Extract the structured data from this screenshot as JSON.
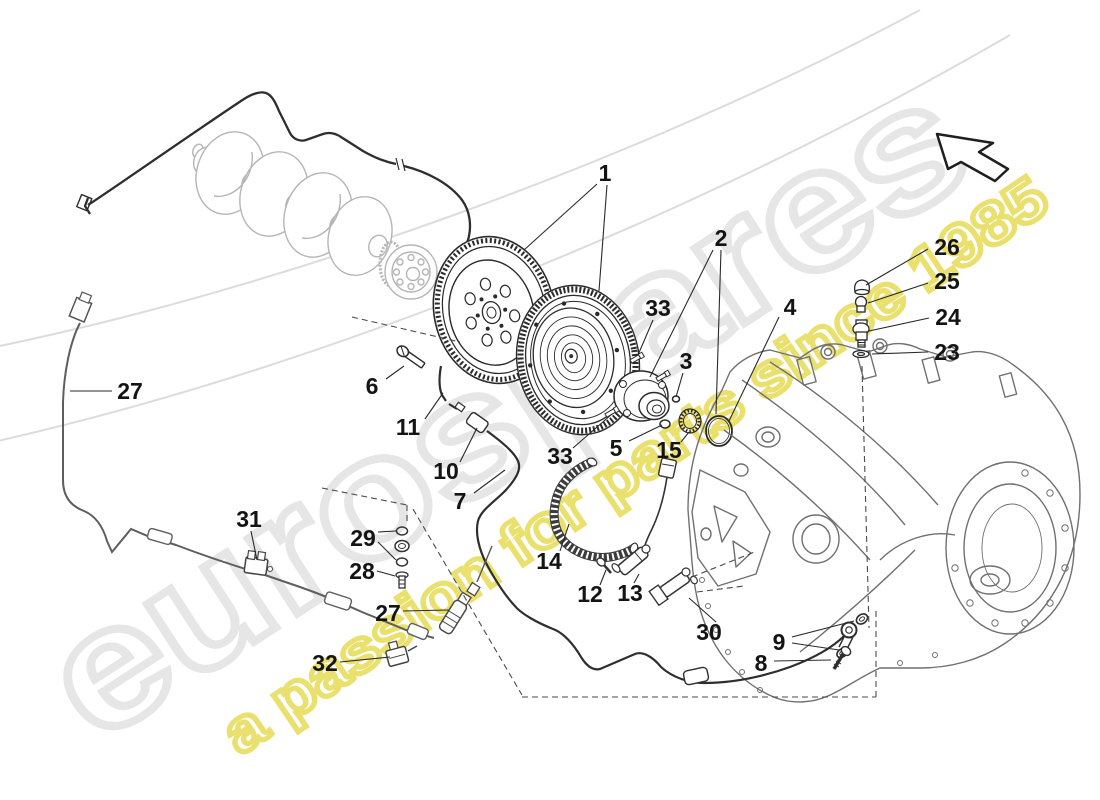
{
  "watermark": {
    "brand": "eurospares",
    "tagline": "a passion for parts since 1985",
    "brand_outline_color": "#e6e6e6",
    "tagline_outline_color": "#e9e06e"
  },
  "colors": {
    "foreground_line": "#2e2e2e",
    "background_part_line": "#b5b5b5",
    "gearbox_line": "#707070",
    "cable_line": "#5e5e5e",
    "label_text": "#141414"
  },
  "icons": {
    "direction_arrow": "nw-cursor-arrow-icon"
  },
  "callouts": [
    {
      "label": "1",
      "x": 605,
      "y": 173,
      "leaders": [
        [
          597,
          184,
          524,
          250
        ],
        [
          607,
          185,
          599,
          291
        ]
      ]
    },
    {
      "label": "2",
      "x": 721,
      "y": 238,
      "leaders": [
        [
          713,
          250,
          650,
          377
        ],
        [
          721,
          250,
          716,
          414
        ]
      ]
    },
    {
      "label": "33",
      "x": 658,
      "y": 308,
      "leaders": [
        [
          653,
          320,
          638,
          355
        ]
      ]
    },
    {
      "label": "3",
      "x": 686,
      "y": 361,
      "leaders": [
        [
          683,
          373,
          676,
          397
        ]
      ]
    },
    {
      "label": "4",
      "x": 790,
      "y": 307,
      "leaders": [
        [
          779,
          317,
          729,
          421
        ]
      ]
    },
    {
      "label": "6",
      "x": 372,
      "y": 386,
      "leaders": [
        [
          386,
          379,
          404,
          366
        ]
      ]
    },
    {
      "label": "11",
      "x": 408,
      "y": 427,
      "leaders": [
        [
          425,
          419,
          443,
          393
        ]
      ]
    },
    {
      "label": "10",
      "x": 446,
      "y": 471,
      "leaders": [
        [
          460,
          462,
          477,
          428
        ]
      ]
    },
    {
      "label": "7",
      "x": 460,
      "y": 501,
      "leaders": [
        [
          474,
          493,
          505,
          470
        ]
      ]
    },
    {
      "label": "33",
      "x": 560,
      "y": 456,
      "leaders": [
        [
          573,
          448,
          612,
          414
        ]
      ]
    },
    {
      "label": "5",
      "x": 616,
      "y": 448,
      "leaders": [
        [
          629,
          441,
          662,
          425
        ]
      ]
    },
    {
      "label": "15",
      "x": 669,
      "y": 450,
      "leaders": [
        [
          681,
          442,
          689,
          432
        ]
      ]
    },
    {
      "label": "14",
      "x": 549,
      "y": 561,
      "leaders": [
        [
          560,
          551,
          569,
          524
        ]
      ]
    },
    {
      "label": "12",
      "x": 590,
      "y": 594,
      "leaders": [
        [
          600,
          585,
          606,
          570
        ]
      ]
    },
    {
      "label": "13",
      "x": 630,
      "y": 593,
      "leaders": [
        [
          634,
          583,
          639,
          574
        ]
      ]
    },
    {
      "label": "30",
      "x": 709,
      "y": 632,
      "leaders": [
        [
          716,
          622,
          689,
          598
        ]
      ]
    },
    {
      "label": "9",
      "x": 779,
      "y": 642,
      "leaders": [
        [
          792,
          637,
          854,
          621
        ],
        [
          792,
          643,
          839,
          650
        ]
      ]
    },
    {
      "label": "8",
      "x": 761,
      "y": 663,
      "leaders": [
        [
          774,
          661,
          831,
          660
        ]
      ]
    },
    {
      "label": "23",
      "x": 947,
      "y": 352,
      "leaders": [
        [
          928,
          352,
          872,
          354
        ]
      ]
    },
    {
      "label": "24",
      "x": 948,
      "y": 317,
      "leaders": [
        [
          929,
          318,
          869,
          331
        ]
      ]
    },
    {
      "label": "25",
      "x": 947,
      "y": 281,
      "leaders": [
        [
          928,
          283,
          868,
          303
        ]
      ]
    },
    {
      "label": "26",
      "x": 947,
      "y": 247,
      "leaders": [
        [
          928,
          249,
          866,
          285
        ]
      ]
    },
    {
      "label": "27",
      "x": 130,
      "y": 391,
      "leaders": [
        [
          112,
          391,
          70,
          391
        ]
      ]
    },
    {
      "label": "31",
      "x": 249,
      "y": 519,
      "leaders": [
        [
          251,
          531,
          257,
          560
        ]
      ]
    },
    {
      "label": "29",
      "x": 363,
      "y": 538,
      "leaders": [
        [
          378,
          532,
          396,
          531
        ],
        [
          378,
          542,
          396,
          560
        ]
      ]
    },
    {
      "label": "28",
      "x": 362,
      "y": 571,
      "leaders": [
        [
          377,
          571,
          395,
          576
        ]
      ]
    },
    {
      "label": "27",
      "x": 388,
      "y": 613,
      "leaders": [
        [
          403,
          611,
          449,
          610
        ]
      ]
    },
    {
      "label": "32",
      "x": 325,
      "y": 663,
      "leaders": [
        [
          340,
          662,
          390,
          657
        ]
      ]
    }
  ]
}
